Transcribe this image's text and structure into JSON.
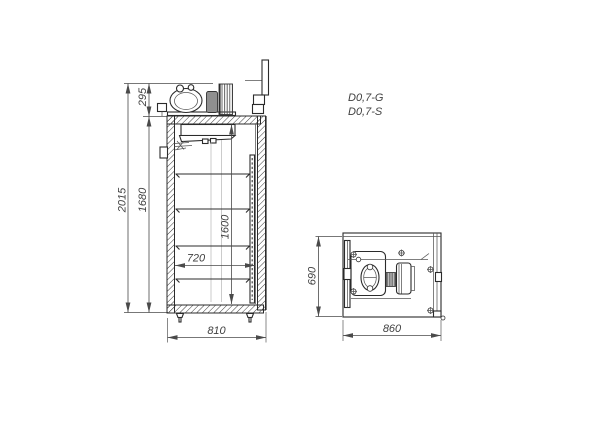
{
  "drawing": {
    "models": {
      "g": "D0,7-G",
      "s": "D0,7-S"
    },
    "side": {
      "overall_height": "2015",
      "body_height": "1680",
      "machine_height": "295",
      "interior_height": "1600",
      "interior_depth": "720",
      "overall_depth": "810"
    },
    "top": {
      "depth": "690",
      "width": "860"
    },
    "colors": {
      "line": "#2b2b2b",
      "dim": "#4a4a4a",
      "background": "#ffffff"
    }
  }
}
